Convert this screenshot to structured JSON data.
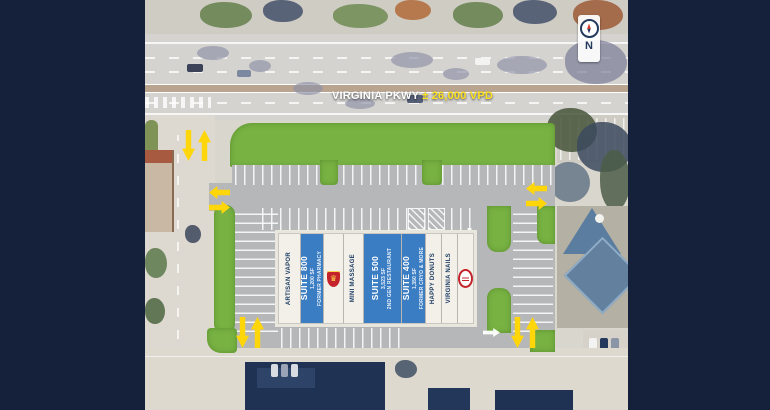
{
  "site_plan": {
    "road": {
      "name": "VIRGINIA PKWY",
      "traffic": "± 26,000 VPD"
    },
    "compass": {
      "label": "N"
    },
    "building": {
      "suites": [
        {
          "type": "tenant",
          "label": "ARTISAN VAPOR"
        },
        {
          "type": "available",
          "label": "SUITE 800",
          "size": "1,200 SF",
          "note": "FORMER PHARMACY"
        },
        {
          "type": "logo",
          "icon": "crest-logo",
          "glyph": "♛"
        },
        {
          "type": "tenant",
          "label": "MINI MASSAGE"
        },
        {
          "type": "available",
          "label": "SUITE 500",
          "size": "3,523 SF",
          "note": "2ND GEN RESTAURANT"
        },
        {
          "type": "available",
          "label": "SUITE 400",
          "size": "1,350 SF",
          "note": "FORMER CRYO & MORE"
        },
        {
          "type": "tenant",
          "label": "HAPPY DONUTS"
        },
        {
          "type": "tenant",
          "label": "VIRGINIA NAILS"
        },
        {
          "type": "logo",
          "icon": "round-logo"
        }
      ]
    },
    "colors": {
      "accent_yellow": "#ffd60a",
      "suite_blue": "#3b7dc3",
      "landscape_green": "#78b243",
      "frame_navy": "#15213a"
    }
  }
}
